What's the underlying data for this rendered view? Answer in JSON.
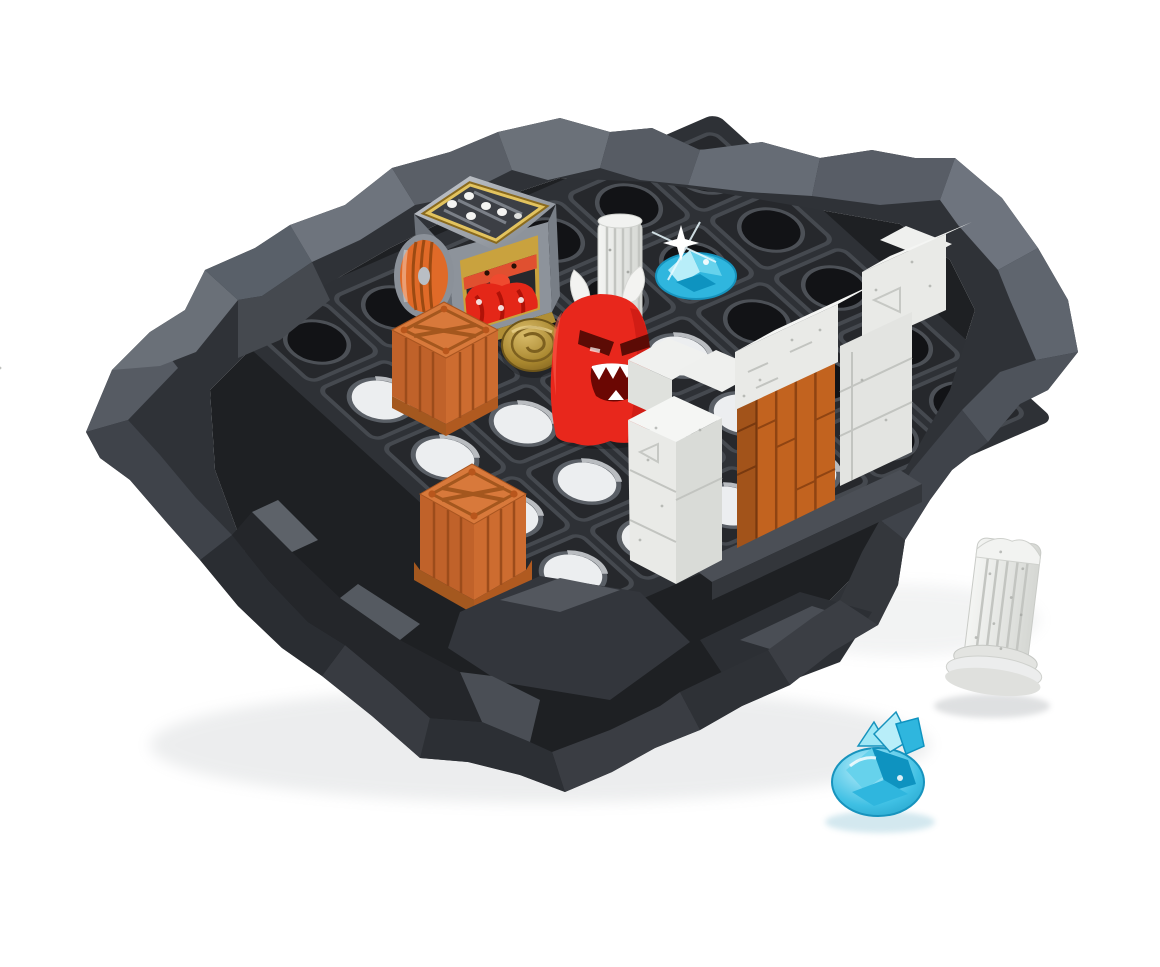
{
  "image": {
    "type": "product-photo",
    "subject": "Dungeon-themed children's board game: dark faceted rock arena with a grid of slots, dice-tumbler with dwarf portrait and barrel, orange crate tokens, gold shield token, red ghost monster, white stone castle gate with wooden door, stone columns and blue gem tokens",
    "background_color": "#ffffff"
  },
  "palette": {
    "rock_dark": "#2f3237",
    "rock_mid": "#4a4f56",
    "rock_light": "#6e747d",
    "tray_dark": "#1e2023",
    "cell_face": "#26282c",
    "hole_light": "#eceef0",
    "crate_orange": "#cd6c30",
    "crate_top": "#d8793b",
    "crate_shadow": "#a4571e",
    "barrel_orange": "#e06a28",
    "ghost_red": "#e8271c",
    "ghost_shade": "#c11810",
    "gold": "#c9a23e",
    "coin_gold": "#b08c34",
    "silver": "#9aa0a8",
    "stone_white": "#e9eae7",
    "stone_top": "#f5f6f4",
    "stone_side": "#d3d5d1",
    "door_wood": "#c2631f",
    "gem_blue": "#2fb6de",
    "gem_deep": "#0e93c0",
    "gem_light": "#b8eef9",
    "mouth_dark": "#6b0703"
  },
  "objects": {
    "rock_base": "dark faceted rock arena platform",
    "grid_tray": "5x6 grid of square slots with round through-holes",
    "dice_tumbler": "silver dice shaker with gold-framed window, dwarf portrait and orange barrel wheel",
    "crate_back": "orange crate token on grid (middle)",
    "crate_front": "orange crate token on grid (front row)",
    "gold_token": "round gold shield token",
    "ghost": "red ghost monster figure with white horns and zigzag teeth",
    "standing_column": "white speckled stone column on grid",
    "castle_wall": "white stone crenellated gate wall",
    "wooden_door": "orange wooden plank door in gate",
    "gem_on_board": "sparkling blue gem token on grid",
    "fallen_column": "white speckled stone column standing off-board, tilted",
    "gem_large": "large blue crystal gem token off-board"
  }
}
